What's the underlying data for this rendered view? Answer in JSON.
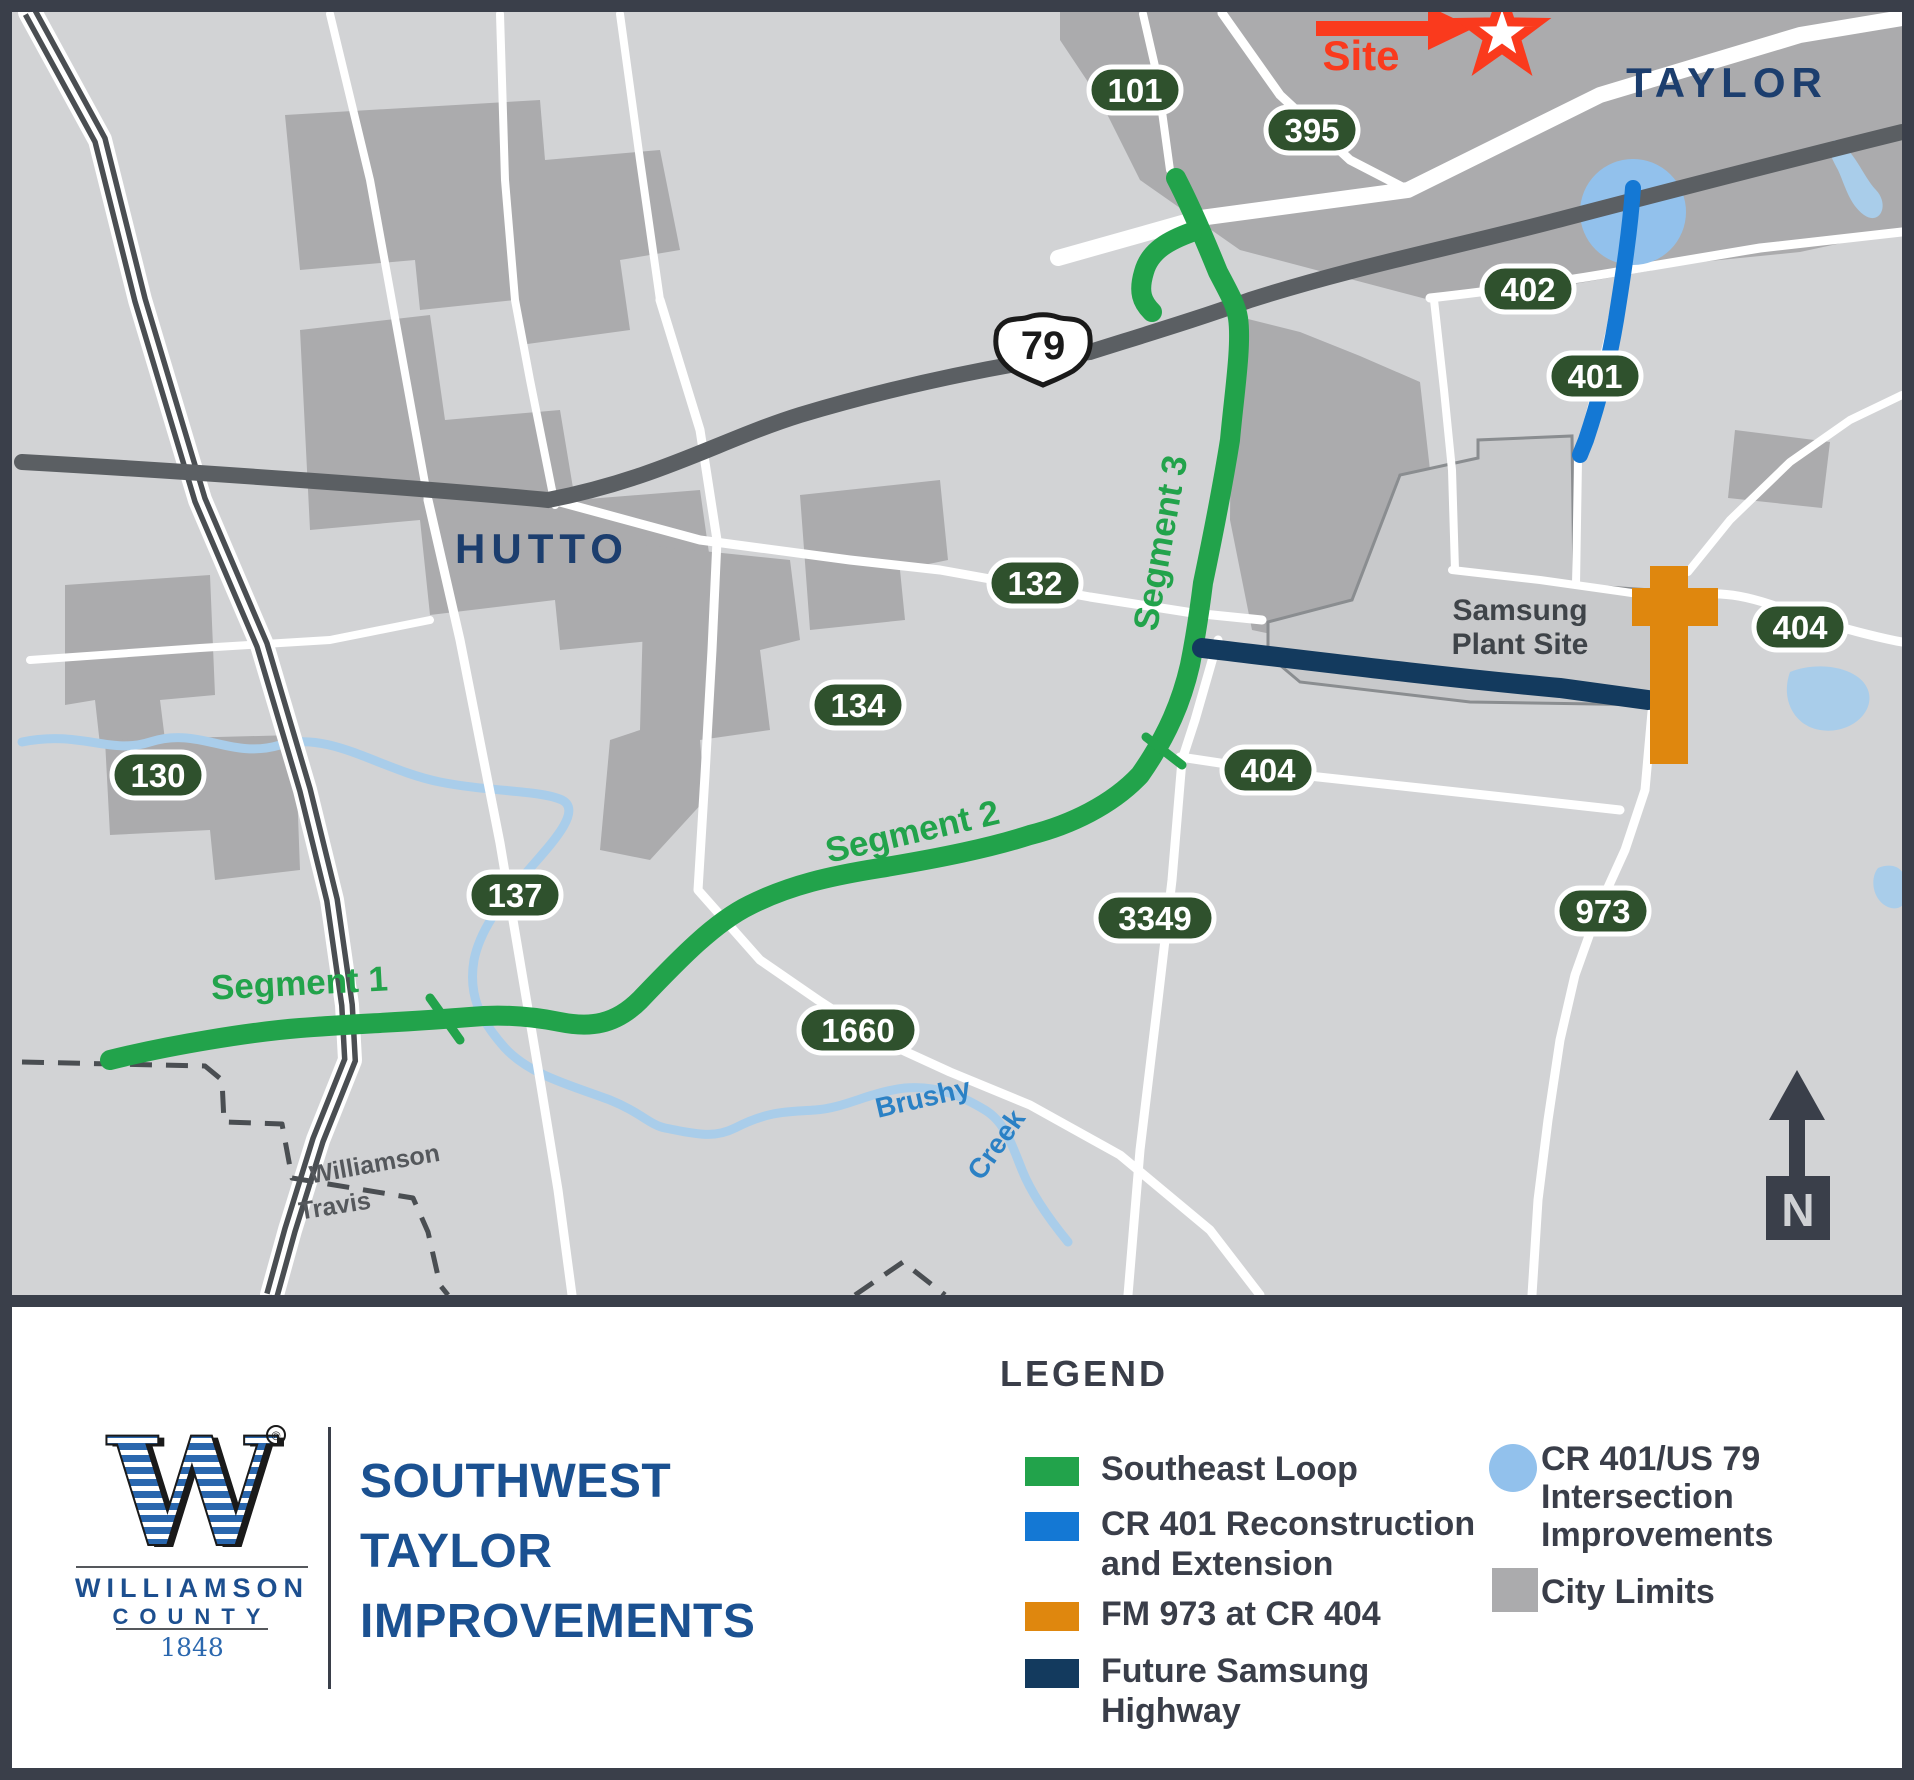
{
  "map": {
    "labels": {
      "taylor": "TAYLOR",
      "hutto": "HUTTO",
      "site": "Site",
      "samsung_line1": "Samsung",
      "samsung_line2": "Plant Site",
      "segment1": "Segment 1",
      "segment2": "Segment 2",
      "segment3": "Segment 3",
      "creek_word1": "Brushy",
      "creek_word2": "Creek",
      "county_north": "Williamson",
      "county_south": "Travis",
      "north": "N",
      "us_route": "79"
    },
    "shields": {
      "s101": "101",
      "s395": "395",
      "s402": "402",
      "s401": "401",
      "s132": "132",
      "s134": "134",
      "s404a": "404",
      "s404b": "404",
      "s130": "130",
      "s137": "137",
      "s3349": "3349",
      "s1660": "1660",
      "s973": "973"
    }
  },
  "legend": {
    "title": "LEGEND",
    "items": [
      {
        "label": "Southeast Loop",
        "color": "#22a34b",
        "shape": "line"
      },
      {
        "label": "CR 401 Reconstruction and Extension",
        "color": "#1478d4",
        "shape": "line"
      },
      {
        "label": "FM 973 at CR 404",
        "color": "#df870e",
        "shape": "line"
      },
      {
        "label": "Future Samsung Highway",
        "color": "#133a5e",
        "shape": "line"
      },
      {
        "label": "CR 401/US 79 Intersection Improvements",
        "color": "#92c1ec",
        "shape": "circle"
      },
      {
        "label": "City Limits",
        "color": "#ababad",
        "shape": "square"
      }
    ]
  },
  "branding": {
    "logo_letter": "W",
    "registered": "®",
    "org_line1": "WILLIAMSON",
    "org_line2": "COUNTY",
    "year": "1848"
  },
  "title": {
    "line1": "SOUTHWEST",
    "line2": "TAYLOR",
    "line3": "IMPROVEMENTS"
  },
  "colors": {
    "southeast_loop_green": "#22a34b",
    "cr401_blue": "#1478d4",
    "fm973_orange": "#df870e",
    "samsung_hwy_navy": "#133a5e",
    "intersection_light_blue": "#92c1ec",
    "city_limits_gray": "#ababad",
    "frame_charcoal": "#3a3f4a",
    "title_blue": "#1b5191",
    "city_label_navy": "#1c3e6e",
    "site_red": "#fa3a1d",
    "shield_green": "#2f512d"
  }
}
